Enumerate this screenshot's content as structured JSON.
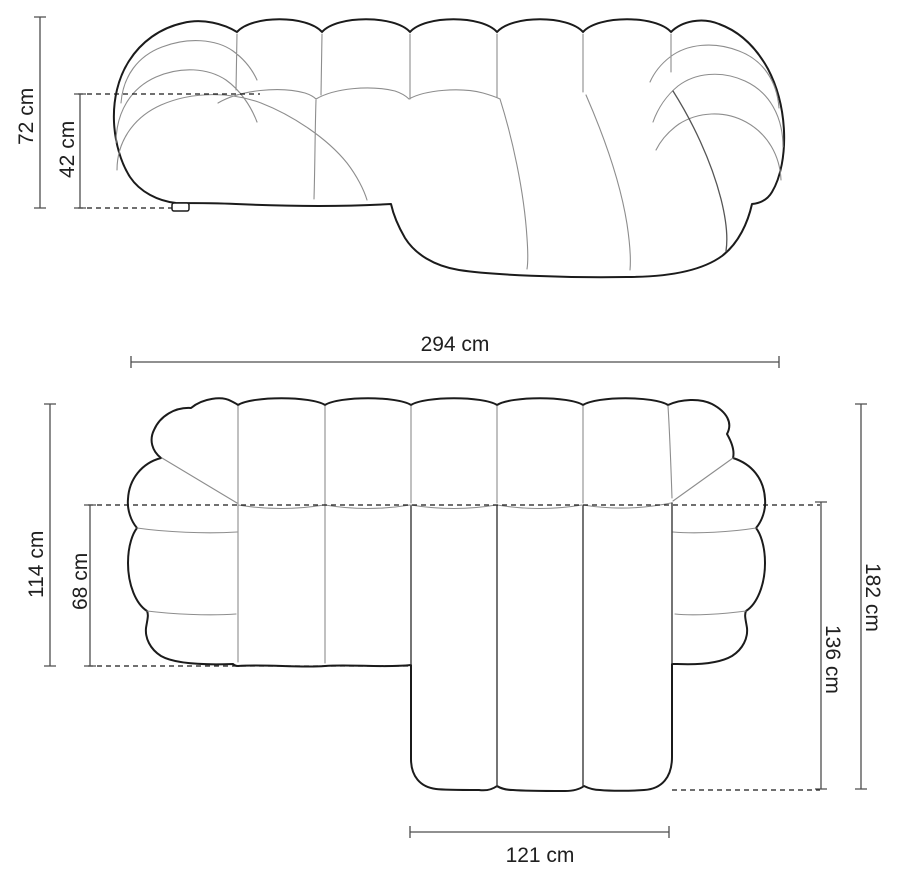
{
  "diagram": {
    "type": "sofa-dimension-drawing",
    "views": {
      "front": {
        "name": "front elevation",
        "dimensions": {
          "total_height": {
            "label": "72 cm",
            "orientation": "vertical-left"
          },
          "seat_height": {
            "label": "42 cm",
            "orientation": "vertical-left"
          }
        }
      },
      "top": {
        "name": "top plan",
        "dimensions": {
          "total_width": {
            "label": "294 cm",
            "orientation": "horizontal-top"
          },
          "body_depth": {
            "label": "114 cm",
            "orientation": "vertical-left"
          },
          "seat_depth": {
            "label": "68 cm",
            "orientation": "vertical-left"
          },
          "total_depth": {
            "label": "182 cm",
            "orientation": "vertical-right"
          },
          "chaise_depth": {
            "label": "136 cm",
            "orientation": "vertical-right"
          },
          "chaise_width": {
            "label": "121 cm",
            "orientation": "horizontal-bottom"
          }
        }
      }
    },
    "colors": {
      "background": "#ffffff",
      "outline": "#1b1b1b",
      "seam": "#8d8d8d",
      "dimension_line": "#4d4d4d",
      "dashed_line": "#1b1b1b",
      "text": "#202020"
    }
  }
}
